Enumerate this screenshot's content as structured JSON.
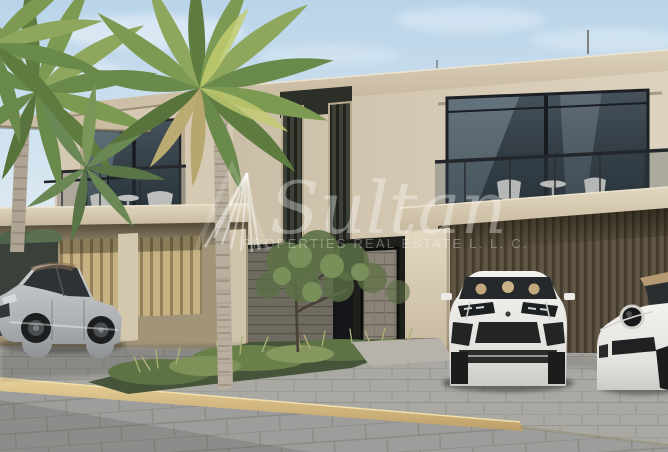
{
  "watermark": {
    "brand": "Sultan",
    "subtitle": "PROPERTIES REAL ESTATE L. L. C.",
    "logo_icon": "sail-fan-monogram-icon"
  },
  "palette": {
    "sky_top": "#b9d4e9",
    "sky_horizon": "#e6eff5",
    "wall_light": "#d9cdb8",
    "wall_shadow": "#b3a78f",
    "wood_slats_dark": "#5a4e3c",
    "wood_slats_light": "#c3ae80",
    "glass_dark": "#2f363c",
    "pavement_gray": "#a7a6a2",
    "curb_sand": "#d4b87e",
    "foliage_green": "#6f8c4a",
    "car_silver": "#b7babc",
    "car_white": "#edebe7",
    "watermark_white": "#ffffff"
  }
}
